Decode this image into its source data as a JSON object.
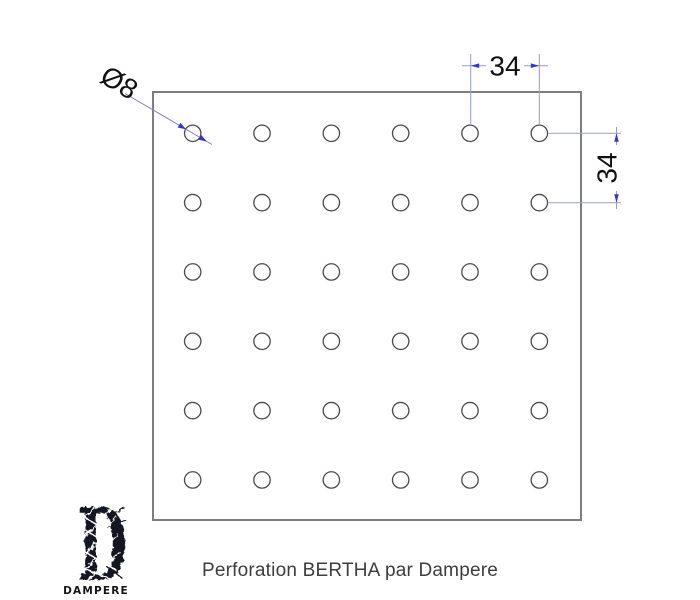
{
  "drawing": {
    "type": "perforation-technical-drawing",
    "dimensions": {
      "hole_diameter": "Ø8",
      "horizontal_spacing": "34",
      "vertical_spacing": "34"
    },
    "holes": {
      "rows": 6,
      "columns": 6
    },
    "colors": {
      "dimension_accent": "#3434cf",
      "dimension_line": "#9a9ad2",
      "plate_outline": "#7e7e7e",
      "hole_outline": "#4a4a4a"
    }
  },
  "footer": {
    "logo_letter": "D",
    "logo_text": "DAMPERE",
    "caption": "Perforation BERTHA par Dampere"
  }
}
